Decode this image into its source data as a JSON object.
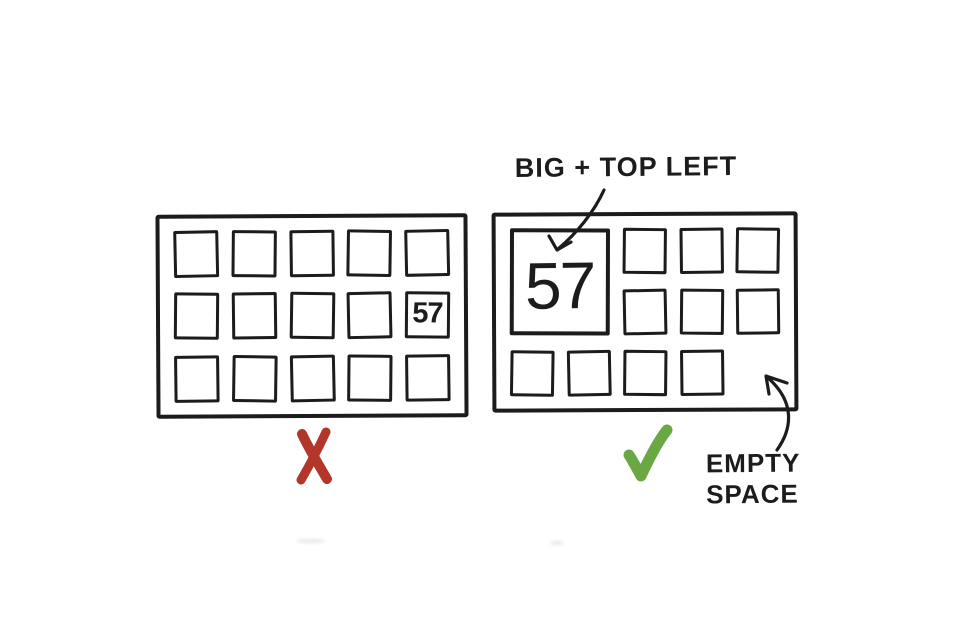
{
  "colors": {
    "ink": "#1c1c1c",
    "cross_red": "#b2372a",
    "check_green": "#6aa844",
    "background": "#ffffff"
  },
  "bad_panel": {
    "grid": {
      "cols": 5,
      "rows": 3,
      "cell_count": 15,
      "value_cell_index": 9
    },
    "value": "57",
    "value_position": "row 2, column 5 (small tile)",
    "verdict_icon": "red-cross"
  },
  "good_panel": {
    "grid": {
      "cols": 5,
      "rows": 3,
      "small_cell_count": 10
    },
    "big_cell": {
      "value": "57",
      "position": "top-left",
      "col_span": 2,
      "row_span": 2
    },
    "empty_cell_position": "bottom-right",
    "verdict_icon": "green-check"
  },
  "annotations": {
    "big_top_left_label": "BIG + TOP LEFT",
    "empty_space_label": "EMPTY\nSPACE"
  }
}
